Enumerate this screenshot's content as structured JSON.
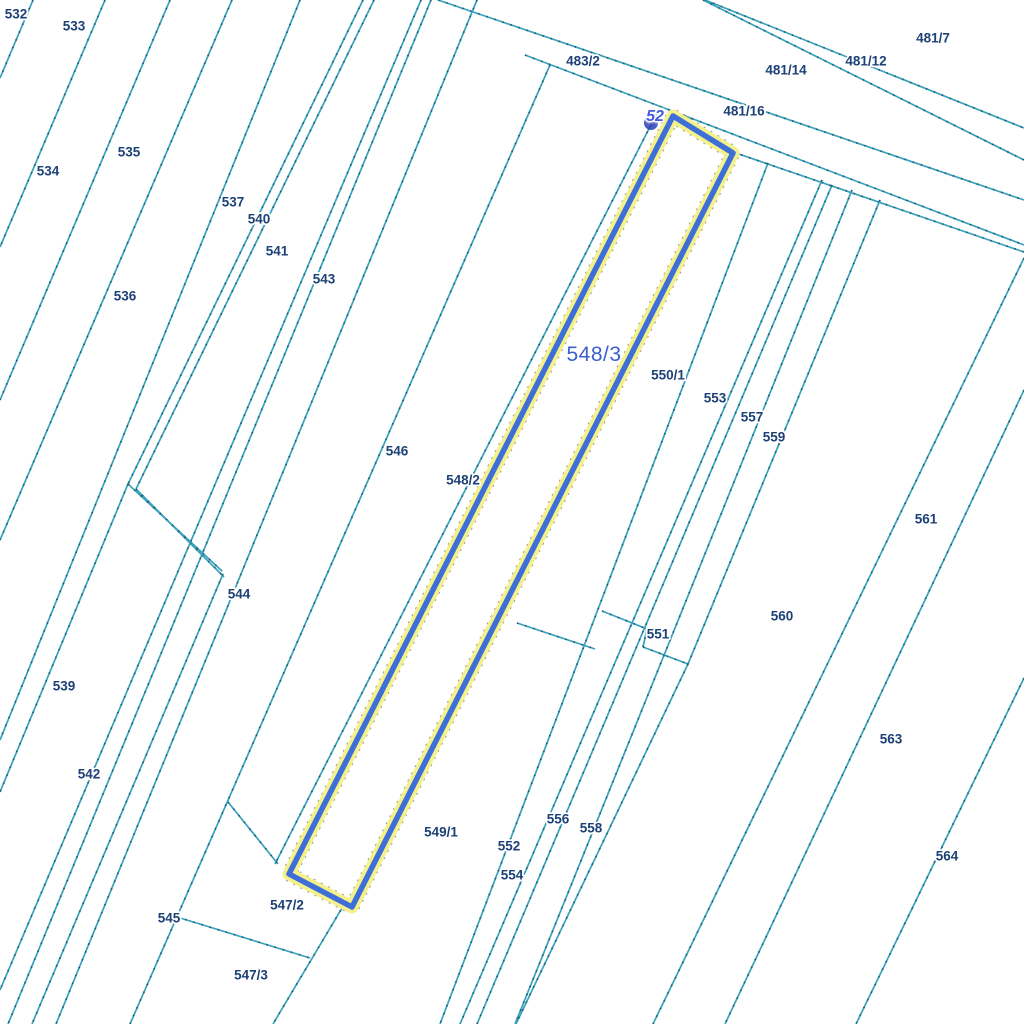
{
  "app": {
    "type": "cadastral-parcel-map",
    "background": "#ffffff"
  },
  "map": {
    "width": 1024,
    "height": 1024,
    "colors": {
      "boundary_teal": "#38a2bd",
      "boundary_dash": "#1c4a63",
      "label_navy": "#1d4176",
      "label_halo": "#ffffff",
      "selected_stroke": "#3e6fd8",
      "selected_halo": "#f4f18c",
      "selected_dash": "#3a3a3a",
      "selected_label_blue": "#3b60ce",
      "marker_blue": "#4758e0",
      "marker_dot": "#2b3db8"
    },
    "boundary_lines": [
      [
        33,
        0,
        0,
        78
      ],
      [
        105,
        0,
        0,
        247
      ],
      [
        170,
        0,
        0,
        400
      ],
      [
        232,
        0,
        0,
        540
      ],
      [
        300,
        0,
        0,
        740
      ],
      [
        363,
        0,
        128,
        484
      ],
      [
        374,
        0,
        136,
        489
      ],
      [
        128,
        484,
        222,
        571
      ],
      [
        136,
        489,
        224,
        577
      ],
      [
        128,
        484,
        0,
        792
      ],
      [
        223,
        574,
        32,
        1024
      ],
      [
        421,
        0,
        0,
        990
      ],
      [
        431,
        0,
        8,
        1024
      ],
      [
        477,
        0,
        56,
        1024
      ],
      [
        550,
        65,
        130,
        1024
      ],
      [
        659,
        109,
        275,
        864
      ],
      [
        228,
        802,
        278,
        864
      ],
      [
        177,
        917,
        310,
        958
      ],
      [
        345,
        903,
        273,
        1024
      ],
      [
        705,
        0,
        1024,
        128
      ],
      [
        703,
        0,
        1024,
        160
      ],
      [
        438,
        0,
        1024,
        200
      ],
      [
        525,
        55,
        1024,
        245
      ],
      [
        733,
        152,
        1024,
        252
      ],
      [
        517,
        623,
        595,
        649
      ],
      [
        602,
        611,
        647,
        629
      ],
      [
        647,
        629,
        643,
        647
      ],
      [
        643,
        647,
        688,
        664
      ],
      [
        768,
        163,
        440,
        1024
      ],
      [
        822,
        180,
        460,
        1024
      ],
      [
        832,
        185,
        477,
        1024
      ],
      [
        852,
        190,
        515,
        1024
      ],
      [
        880,
        200,
        688,
        664
      ],
      [
        688,
        664,
        516,
        1024
      ],
      [
        1024,
        258,
        653,
        1024
      ],
      [
        1024,
        390,
        725,
        1024
      ],
      [
        1024,
        678,
        856,
        1024
      ]
    ],
    "selected_parcel": {
      "id": "548/3",
      "label": "548/3",
      "polygon": [
        [
          673,
          116
        ],
        [
          733,
          153
        ],
        [
          352,
          907
        ],
        [
          289,
          874
        ]
      ],
      "label_x": 594,
      "label_y": 355
    },
    "marker": {
      "text": "52",
      "x": 655,
      "y": 117,
      "dot_x": 651,
      "dot_y": 123
    },
    "parcel_labels": [
      {
        "text": "532",
        "x": 16,
        "y": 15
      },
      {
        "text": "533",
        "x": 74,
        "y": 27
      },
      {
        "text": "534",
        "x": 48,
        "y": 172
      },
      {
        "text": "535",
        "x": 129,
        "y": 153
      },
      {
        "text": "536",
        "x": 125,
        "y": 297
      },
      {
        "text": "537",
        "x": 233,
        "y": 203
      },
      {
        "text": "540",
        "x": 259,
        "y": 220
      },
      {
        "text": "541",
        "x": 277,
        "y": 252
      },
      {
        "text": "543",
        "x": 324,
        "y": 280
      },
      {
        "text": "544",
        "x": 239,
        "y": 595
      },
      {
        "text": "539",
        "x": 64,
        "y": 687
      },
      {
        "text": "542",
        "x": 89,
        "y": 775
      },
      {
        "text": "545",
        "x": 169,
        "y": 919
      },
      {
        "text": "546",
        "x": 397,
        "y": 452
      },
      {
        "text": "548/2",
        "x": 463,
        "y": 481
      },
      {
        "text": "547/2",
        "x": 287,
        "y": 906
      },
      {
        "text": "547/3",
        "x": 251,
        "y": 976
      },
      {
        "text": "549/1",
        "x": 441,
        "y": 833
      },
      {
        "text": "552",
        "x": 509,
        "y": 847
      },
      {
        "text": "554",
        "x": 512,
        "y": 876
      },
      {
        "text": "556",
        "x": 558,
        "y": 820
      },
      {
        "text": "558",
        "x": 591,
        "y": 829
      },
      {
        "text": "551",
        "x": 658,
        "y": 635
      },
      {
        "text": "550/1",
        "x": 668,
        "y": 376
      },
      {
        "text": "553",
        "x": 715,
        "y": 399
      },
      {
        "text": "557",
        "x": 752,
        "y": 418
      },
      {
        "text": "559",
        "x": 774,
        "y": 438
      },
      {
        "text": "560",
        "x": 782,
        "y": 617
      },
      {
        "text": "561",
        "x": 926,
        "y": 520
      },
      {
        "text": "563",
        "x": 891,
        "y": 740
      },
      {
        "text": "564",
        "x": 947,
        "y": 857
      },
      {
        "text": "483/2",
        "x": 583,
        "y": 62
      },
      {
        "text": "481/16",
        "x": 744,
        "y": 112
      },
      {
        "text": "481/14",
        "x": 786,
        "y": 71
      },
      {
        "text": "481/12",
        "x": 866,
        "y": 62
      },
      {
        "text": "481/7",
        "x": 933,
        "y": 39
      }
    ]
  }
}
